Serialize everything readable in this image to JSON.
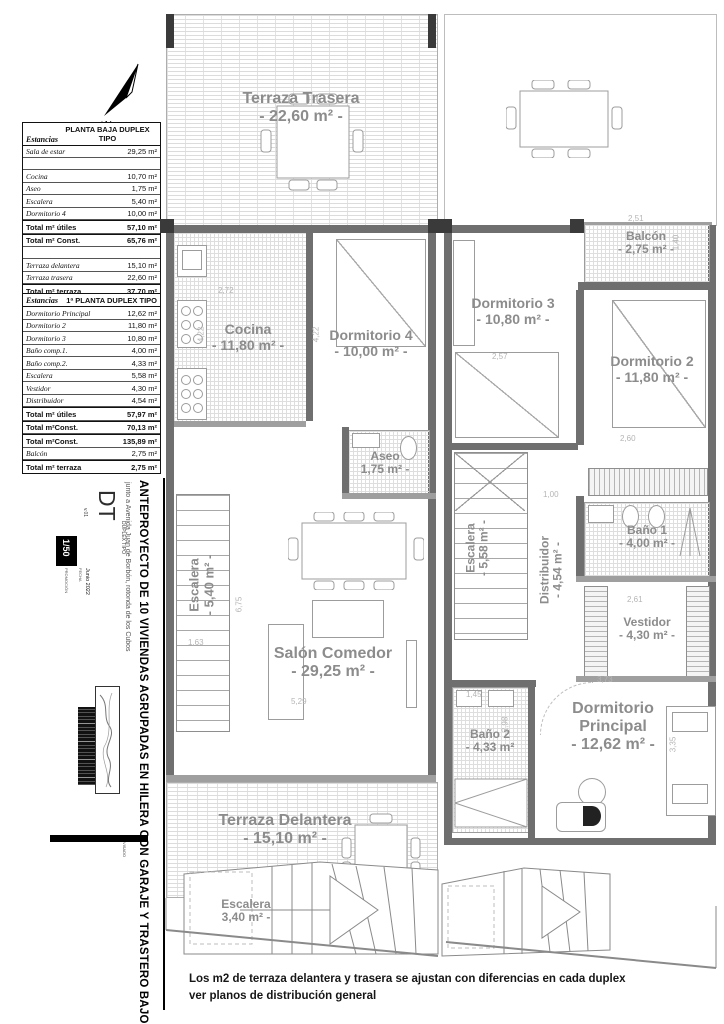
{
  "compass": {
    "label": "N"
  },
  "tables": {
    "planta_baja": {
      "col1_header": "Estancias",
      "col2_header_line1": "PLANTA BAJA",
      "col2_header_line2": "DUPLEX TIPO",
      "rows": [
        {
          "name": "Sala de estar",
          "value": "29,25 m²"
        },
        {
          "name": "Cocina",
          "value": "10,70 m²"
        },
        {
          "name": "Aseo",
          "value": "1,75 m²"
        },
        {
          "name": "Escalera",
          "value": "5,40 m²"
        },
        {
          "name": "Dormitorio 4",
          "value": "10,00 m²"
        },
        {
          "name": "Total m² útiles",
          "value": "57,10 m²"
        },
        {
          "name": "Total m² Const.",
          "value": "65,76 m²"
        },
        {
          "name": "Terraza delantera",
          "value": "15,10 m²"
        },
        {
          "name": "Terraza trasera",
          "value": "22,60 m²"
        },
        {
          "name": "Total m² terraza",
          "value": "37,70 m²"
        }
      ]
    },
    "primera_planta": {
      "col1_header": "Estancias",
      "col2_header_line1": "1ª PLANTA",
      "col2_header_line2": "DUPLEX TIPO",
      "rows": [
        {
          "name": "Dormitorio Principal",
          "value": "12,62 m²"
        },
        {
          "name": "Dormitorio 2",
          "value": "11,80 m²"
        },
        {
          "name": "Dormitorio 3",
          "value": "10,80 m²"
        },
        {
          "name": "Baño comp.1.",
          "value": "4,00 m²"
        },
        {
          "name": "Baño comp.2.",
          "value": "4,33 m²"
        },
        {
          "name": "Escalera",
          "value": "5,58 m²"
        },
        {
          "name": "Vestidor",
          "value": "4,30 m²"
        },
        {
          "name": "Distribuidor",
          "value": "4,54 m²"
        },
        {
          "name": "Total m² útiles",
          "value": "57,97 m²"
        },
        {
          "name": "Total  m²Const.",
          "value": "70,13 m²"
        },
        {
          "name": "Total  m²Const.",
          "value": "135,89 m²"
        },
        {
          "name": "Balcón",
          "value": "2,75 m²"
        },
        {
          "name": "Total m² terraza",
          "value": "2,75 m²"
        }
      ]
    }
  },
  "rooms": {
    "terraza_trasera": {
      "name": "Terraza Trasera",
      "area": "- 22,60 m² -"
    },
    "cocina": {
      "name": "Cocina",
      "area": "- 11,80 m² -"
    },
    "dormitorio_4": {
      "name": "Dormitorio 4",
      "area": "- 10,00 m² -"
    },
    "aseo": {
      "name": "Aseo",
      "area": "1,75 m² -"
    },
    "escalera_pb": {
      "name": "Escalera",
      "area": "- 5,40 m² -"
    },
    "salon": {
      "name": "Salón Comedor",
      "area": "- 29,25 m² -"
    },
    "terraza_delantera": {
      "name": "Terraza Delantera",
      "area": "- 15,10 m² -"
    },
    "escalera_exterior": {
      "name": "Escalera",
      "area": "3,40 m² -"
    },
    "dormitorio_3": {
      "name": "Dormitorio 3",
      "area": "- 10,80 m² -"
    },
    "balcon": {
      "name": "Balcón",
      "area": "- 2,75 m² -"
    },
    "dormitorio_2": {
      "name": "Dormitorio 2",
      "area": "- 11,80 m² -"
    },
    "escalera_p1": {
      "name": "Escalera",
      "area": "- 5,58 m² -"
    },
    "distribuidor": {
      "name": "Distribuidor",
      "area": "- 4,54 m² -"
    },
    "bano_1": {
      "name": "Baño 1",
      "area": "- 4,00 m² -"
    },
    "vestidor": {
      "name": "Vestidor",
      "area": "- 4,30 m² -"
    },
    "bano_2": {
      "name": "Baño 2",
      "area": "- 4,33 m²"
    },
    "dormitorio_principal": {
      "name": "Dormitorio",
      "name2": "Principal",
      "area": "- 12,62 m² -"
    }
  },
  "dims": [
    "2,72",
    "4,22",
    "4,22",
    "2,57",
    "2,51",
    "1,40",
    "2,60",
    "1,00",
    "2,61",
    "3,73",
    "1,45",
    "2,98",
    "3,35",
    "6,75",
    "5,29",
    "1,63"
  ],
  "title_block": {
    "project_title": "ANTEPROYECTO DE 10 VIVIENDAS AGRUPADAS EN HILERA CON GARAJE Y TRASTERO BAJO CUBIERTA",
    "location": "junto a Avenida Juan de Borbón, rotonda de los Cubos",
    "sheet_code": "DT",
    "sheet_name": "DUPLEX TIPO",
    "version": "v.01",
    "scale": "1/50",
    "promo_label": "PROMOCIÓN",
    "date_label": "FECHA",
    "date": "Junio 2022",
    "visado": "VISADO"
  },
  "footnote": {
    "line1": "Los m2 de terraza delantera y trasera se ajustan con diferencias en cada duplex",
    "line2": "ver planos de distribución general"
  }
}
